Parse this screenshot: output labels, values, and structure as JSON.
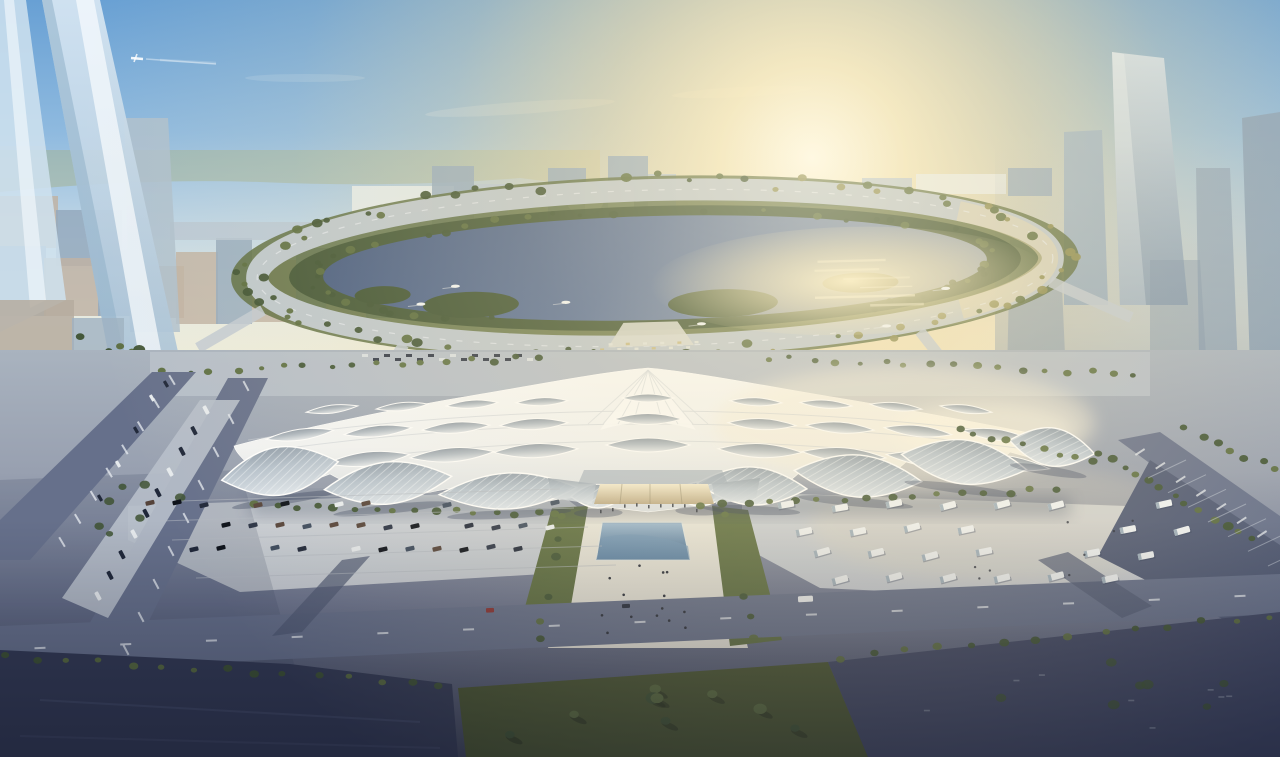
{
  "meta": {
    "title": "Aerial rendering of a lakeside exhibition and convention center at golden hour",
    "type": "architectural-rendering",
    "view": "aerial-oblique",
    "time_of_day": "golden-hour"
  },
  "scene": {
    "description": "Photorealistic aerial rendering: a vast exhibition center with an undulating white canopy roof pierced by rows of eye-shaped skylights and lattice-glazed lens bays sits before a circular lake ringed by a tree-lined boulevard. The low sun floods the right half of the image with warm glare, glittering on the water. Tall translucent glass towers rise in the left foreground, hazy skyscrapers line the right horizon, a small white dome building stands on the far lakeshore, boats cross the lake, parking aprons with cars (left) and white shuttle buses (right) flank a central axis with a blue reflecting pool, and dark rooftops, lawns and boulevards fill the foreground. A tiny airplane with a contrail crosses the upper-left sky.",
    "elements": [
      {
        "name": "exhibition-hall",
        "desc": "white wave-canopy exhibition center with eye-shaped skylights and glazed lens bays"
      },
      {
        "name": "circular-lake",
        "desc": "round lake with islands, boats and sun glare"
      },
      {
        "name": "ring-boulevard",
        "desc": "tree-lined circular road around the lake"
      },
      {
        "name": "dome-building",
        "desc": "small white dome on the far lakeshore"
      },
      {
        "name": "left-glass-towers",
        "desc": "tall translucent leaning glass towers, left foreground"
      },
      {
        "name": "right-tower-cluster",
        "desc": "hazy high-rise cluster on the right horizon"
      },
      {
        "name": "central-axis",
        "desc": "pedestrian axis with reflecting pool and lawns"
      },
      {
        "name": "left-parking-lot",
        "desc": "car parking apron"
      },
      {
        "name": "right-bus-lot",
        "desc": "shuttle-bus parking apron"
      },
      {
        "name": "foreground-blocks",
        "desc": "dark rooftops, lawn and boulevards at bottom"
      },
      {
        "name": "airplane",
        "desc": "small airplane with contrail in upper-left sky"
      }
    ]
  },
  "colors": {
    "sky_top": "#68A0D4",
    "sky_upper": "#8FBADF",
    "sky_mid": "#C3D8E6",
    "sky_horizon": "#E9EBE0",
    "sun_core": "#FFFBEC",
    "sun_warm": "#FAE9B8",
    "sun_outer": "#F3D99E",
    "hills": "#A3B18F",
    "city_haze": "#A9BCCB",
    "city_tan": "#BFB3A4",
    "city_slate": "#94A9BD",
    "city_pale": "#B9C7D3",
    "city_white": "#E9EDEC",
    "city_light_tan": "#CDC4B4",
    "dome_white": "#F3F5F1",
    "rtower_lit": "#D2DFE9",
    "rtower_shade": "#879DB5",
    "haze_blue": "#8FA4BA",
    "ltower_face": "#BED3E6",
    "ltower_stripe": "#F5FAFE",
    "ltower_shade": "#9EBAD2",
    "green_dark": "#3E5233",
    "green_mid": "#5A6B3E",
    "green_gold": "#8D8C52",
    "lake_dark": "#44597E",
    "lake_mid": "#5A7199",
    "lake_light": "#7E90AC",
    "lake_glare": "#F4E6B8",
    "ring_road": "#C2CBD4",
    "ring_warm": "#E9D9AE",
    "road_dark": "#4E5873",
    "road_mid": "#66708B",
    "marking": "#E8ECF2",
    "plaza_light": "#CBD1D7",
    "plaza_warm": "#DBD7CC",
    "axis_light": "#E6E4DB",
    "roof_top": "#FAFBFB",
    "roof_white": "#F1F3F4",
    "roof_shade": "#C8CED5",
    "roof_warm": "#F8F0DC",
    "lens_dark": "#8C97A4",
    "lens_light": "#E6EAEE",
    "facade_glass": "#B6C2CE",
    "facade_dark": "#919EAC",
    "entrance_glow": "#EBDFC0",
    "pool_light": "#9BB8D2",
    "pool_dark": "#3A658F",
    "dark_bldg_left": "#333A54",
    "dark_bldg_right": "#3F4663",
    "lawn_dark": "#48542F",
    "car_dark": "#20283A",
    "bus_white": "#EFF2F4",
    "shadow": "#2E3A57",
    "people": "#262B38"
  },
  "counts": {
    "boats": 6,
    "buses_in_right_lot": 25,
    "cars_in_left_lot": 32,
    "cars_in_roadside_strip": 10,
    "exhibition_roof_skylight_rows": 3,
    "facade_lens_bays": 9,
    "foreground_glass_towers_left": 2,
    "distant_towers_right": 4,
    "airplanes": 1
  }
}
